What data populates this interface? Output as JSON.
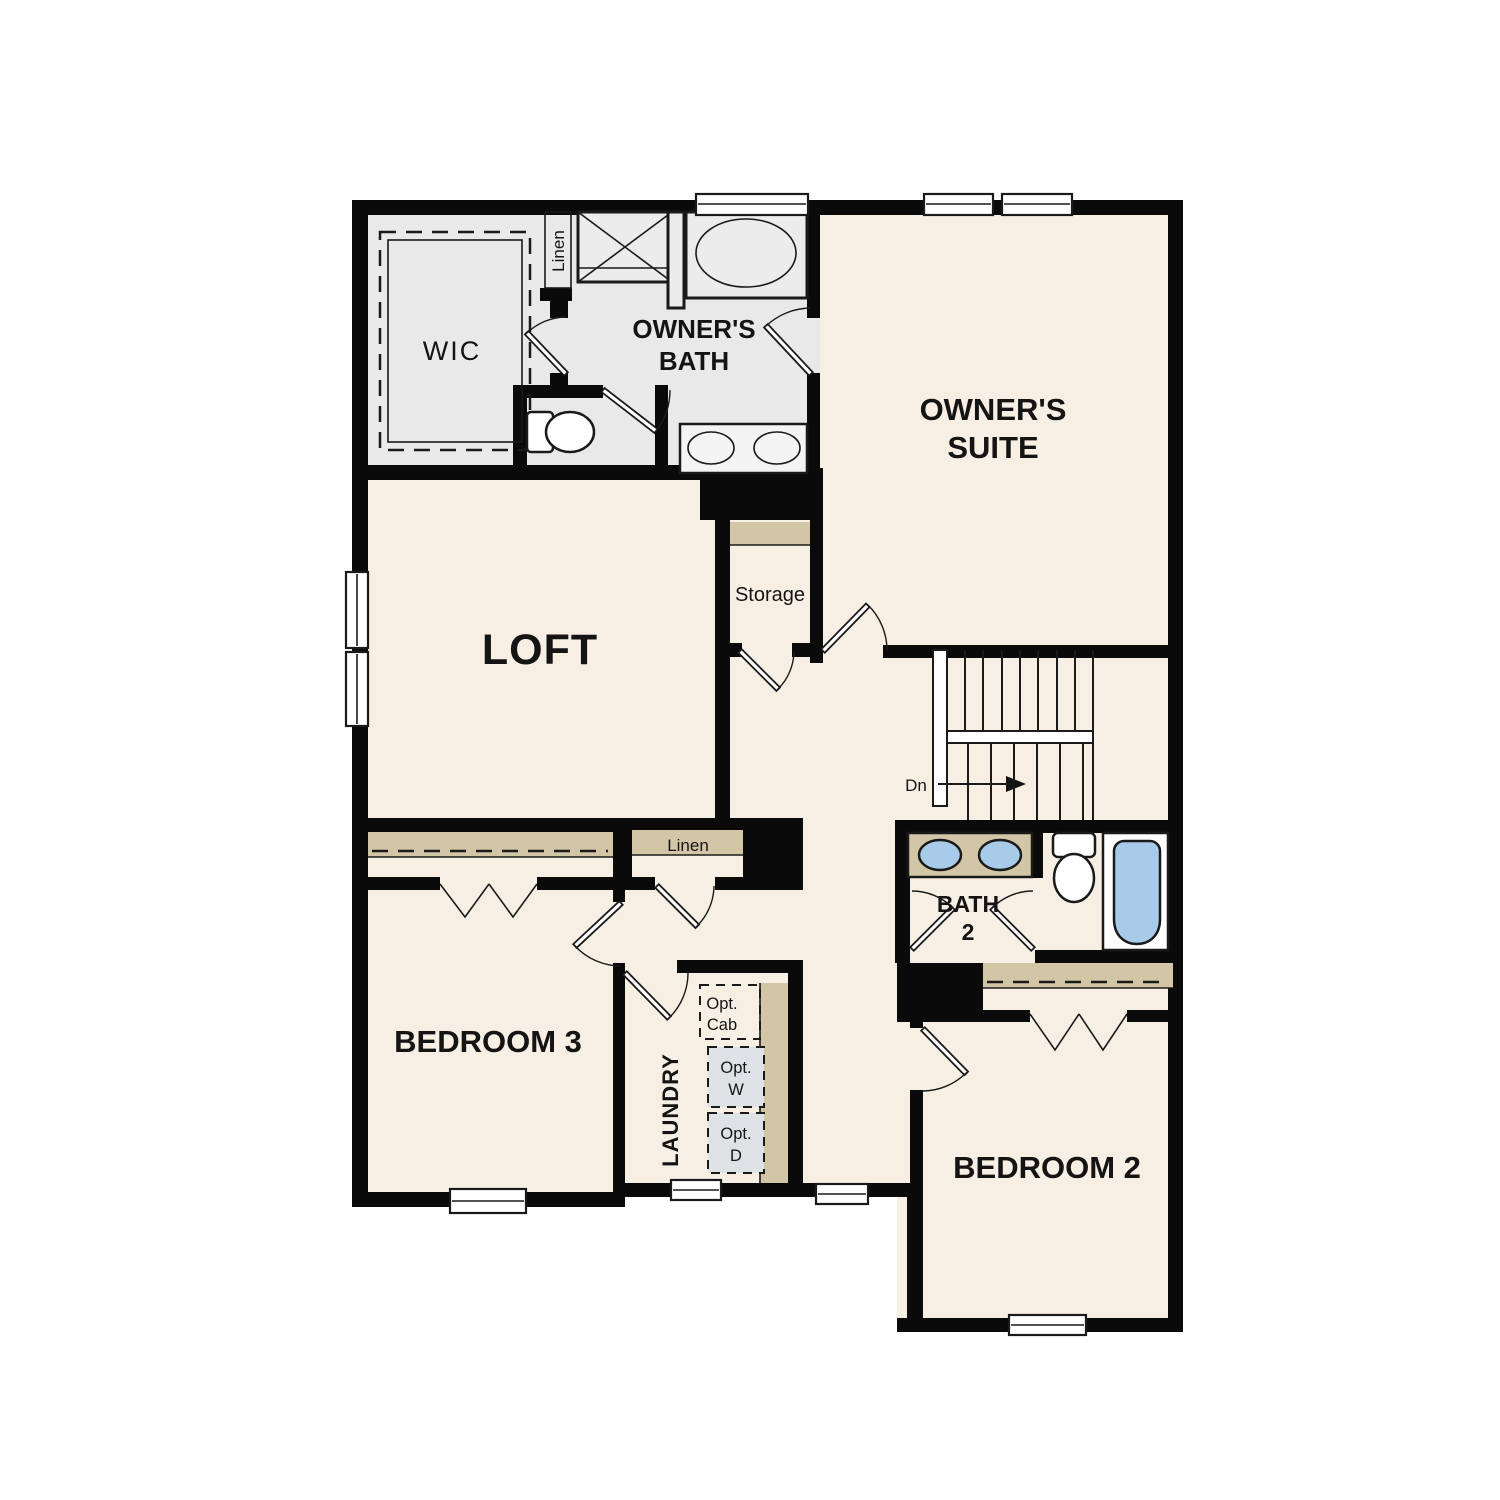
{
  "rooms": {
    "wic": {
      "label": "WIC"
    },
    "linen_upper": {
      "label": "Linen"
    },
    "owners_bath": {
      "line1": "OWNER'S",
      "line2": "BATH"
    },
    "owners_suite": {
      "line1": "OWNER'S",
      "line2": "SUITE"
    },
    "loft": {
      "label": "LOFT"
    },
    "storage": {
      "label": "Storage"
    },
    "stairs": {
      "down_label": "Dn"
    },
    "bath2": {
      "line1": "BATH",
      "line2": "2"
    },
    "bedroom3": {
      "label": "BEDROOM 3"
    },
    "linen_hall": {
      "label": "Linen"
    },
    "laundry": {
      "label": "LAUNDRY",
      "opt_cab": {
        "line1": "Opt.",
        "line2": "Cab"
      },
      "opt_washer": {
        "line1": "Opt.",
        "line2": "W"
      },
      "opt_dryer": {
        "line1": "Opt.",
        "line2": "D"
      }
    },
    "bedroom2": {
      "label": "BEDROOM 2"
    }
  },
  "colors": {
    "wall": "#0a0a0a",
    "floor_cream": "#f8efe4",
    "floor_gray": "#e9e9e9",
    "shelf_tan": "#d3c6a6",
    "fixture_blue": "#a9cbea",
    "appliance_gray": "#dde3e4",
    "line": "#1a1a1a",
    "background": "#ffffff"
  }
}
